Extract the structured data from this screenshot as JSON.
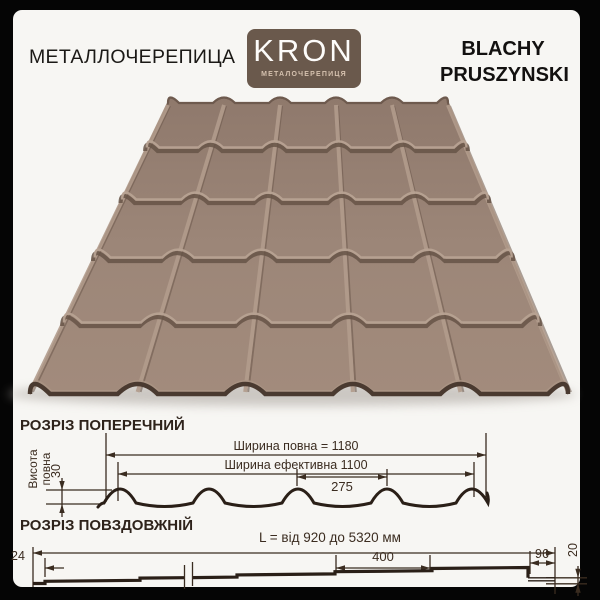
{
  "frame": {
    "bg": "#050505",
    "panel_bg": "#f7f6f3"
  },
  "header": {
    "left_title": "МЕТАЛЛОЧЕРЕПИЦА",
    "brand_line1": "BLACHY",
    "brand_line2": "PRUSZYNSKI"
  },
  "logo": {
    "text": "KRON",
    "subtitle": "МЕТАЛОЧЕРЕПИЦЯ",
    "bg_color": "#6a594c",
    "subtitle_color": "#d5c1ae"
  },
  "roof": {
    "description": "brown metal roof tile sheet, 5 columns x 5 rows of modules, perspective view",
    "color": "#9b8577"
  },
  "cross_section": {
    "title": "РОЗРІЗ ПОПЕРЕЧНИЙ",
    "full_width_label": "Ширина повна = 1180",
    "effective_width_label": "Ширина ефективна 1100",
    "module_width": "275",
    "height_label_line1": "Висота",
    "height_label_line2": "повна",
    "height_value": "30"
  },
  "long_section": {
    "title": "РОЗРІЗ ПОВЗДОВЖНІЙ",
    "length_label": "L = від 920 до 5320 мм",
    "edge_offset": "24",
    "module_length": "400",
    "end_module": "96",
    "step_height": "20"
  }
}
